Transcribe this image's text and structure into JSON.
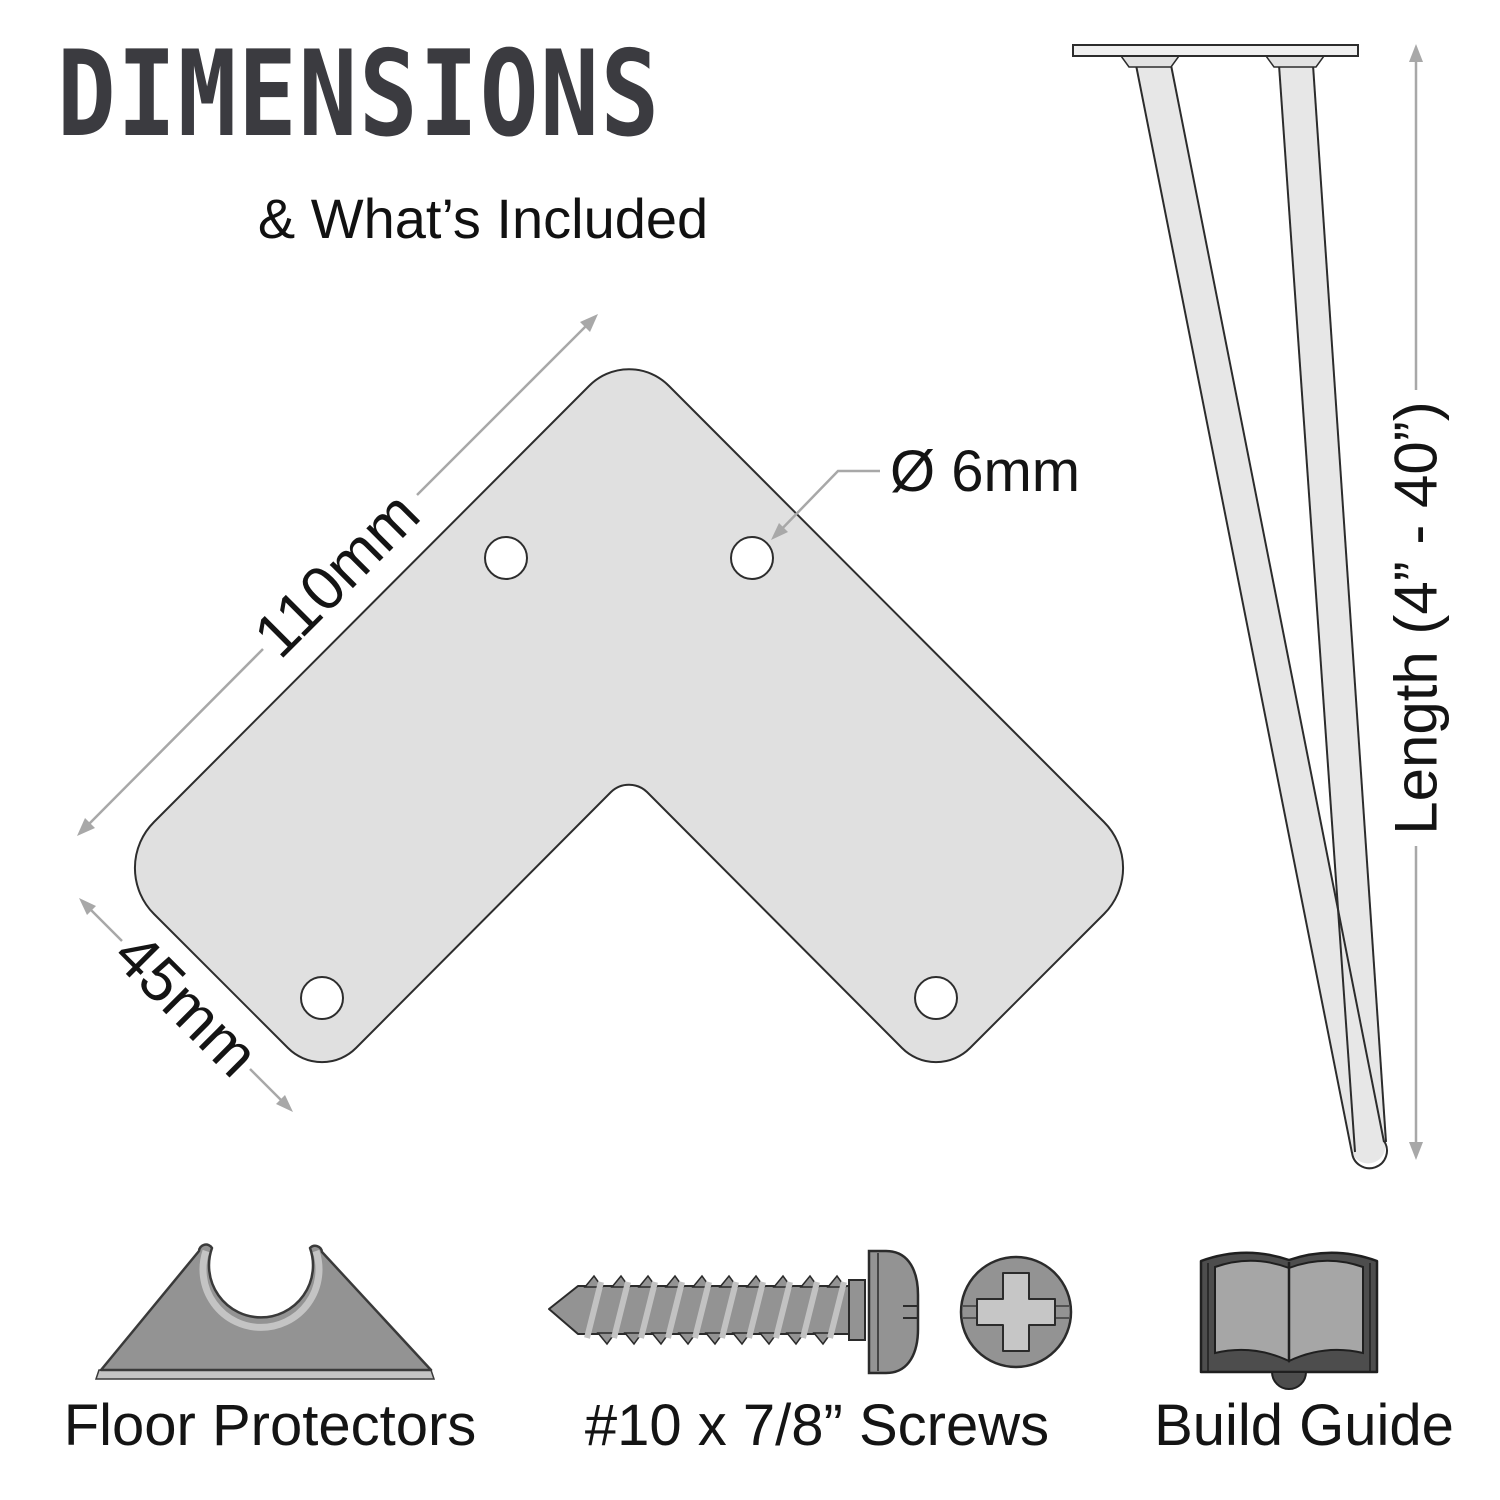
{
  "header": {
    "title": "DIMENSIONS",
    "subtitle": "& What’s Included"
  },
  "plate": {
    "name": "L-shaped mounting plate",
    "arm_length_label": "110mm",
    "arm_width_label": "45mm",
    "hole_diameter_label": "Ø 6mm",
    "hole_count": 4,
    "fill_color": "#e0e0e0",
    "outline_color": "#2d2d2d"
  },
  "leg": {
    "name": "2-rod hairpin leg",
    "length_label": "Length (4” - 40”)",
    "length_min_inches": 4,
    "length_max_inches": 40,
    "fill_color": "#e7e7e7",
    "outline_color": "#2c2c2c"
  },
  "included": [
    {
      "label": "Floor Protectors"
    },
    {
      "label": "#10 x 7/8” Screws"
    },
    {
      "label": "Build Guide"
    }
  ],
  "colors": {
    "dimension_line": "#a8a8a8",
    "label_text": "#141414",
    "title_text": "#3b3b40",
    "icon_gray": "#939393",
    "icon_light_gray": "#c4c4c4",
    "icon_dark_gray": "#4d4d4d",
    "background": "#ffffff"
  }
}
